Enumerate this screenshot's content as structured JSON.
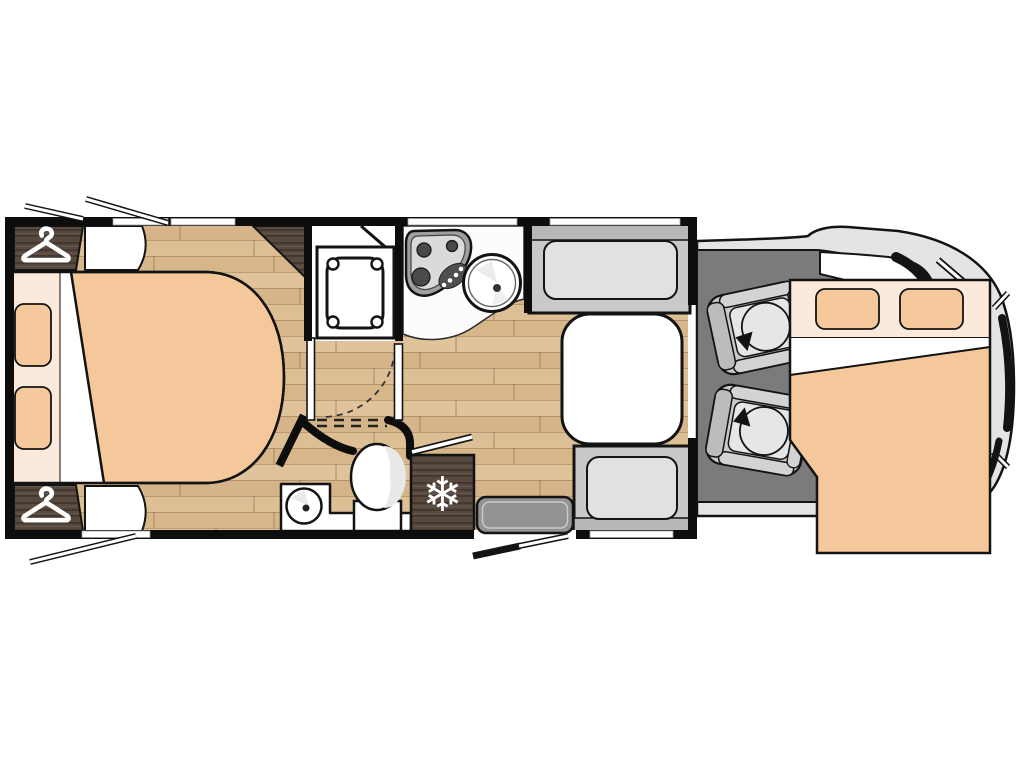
{
  "meta": {
    "type": "motorhome-floorplan",
    "view": "top-down-layout",
    "background": "#ffffff"
  },
  "palette": {
    "wall": "#0d0d0d",
    "floor_wood": "#dcbe94",
    "dark_wood": "#57493e",
    "mattress_orange": "#f5c89b",
    "pillow_orange": "#f6c99c",
    "linen_cream": "#fbeadc",
    "fixture_white": "#ffffff",
    "bench_frame": "#c9c9c9",
    "bench_cushion": "#e1e1e1",
    "cab_floor": "#7b7b7b",
    "vehicle_body": "#e4e4e4",
    "step_gray": "#939393"
  },
  "icons": {
    "snowflake_glyph": "❄",
    "wardrobe_icon": "clothes-hanger",
    "seat_icon": "swivel-rotation-arrow"
  },
  "zones": {
    "rear_bedroom": {
      "features": [
        "island-double-bed",
        "two-pillows",
        "wardrobe-top",
        "wardrobe-bottom",
        "corner-cabinet",
        "bedside-cabinets",
        "opening-windows"
      ]
    },
    "washroom": {
      "features": [
        "shower-cubicle",
        "shower-tray",
        "pivot-door",
        "toilet",
        "washbasin",
        "vanity-counter"
      ]
    },
    "kitchen": {
      "features": [
        "three-burner-hob",
        "round-sink",
        "worktop",
        "window"
      ]
    },
    "dinette": {
      "features": [
        "front-bench-seat",
        "rear-bench-seat",
        "table",
        "windows"
      ]
    },
    "entrance": {
      "features": [
        "entry-door-open",
        "entry-step",
        "refrigerator"
      ]
    },
    "cab": {
      "features": [
        "driver-swivel-seat",
        "passenger-swivel-seat",
        "dashboard",
        "windscreen-pillar",
        "mirrors",
        "headlights"
      ]
    },
    "overcab": {
      "features": [
        "drop-down-double-bed",
        "two-pillows",
        "duvet",
        "sheet-fold"
      ]
    }
  }
}
